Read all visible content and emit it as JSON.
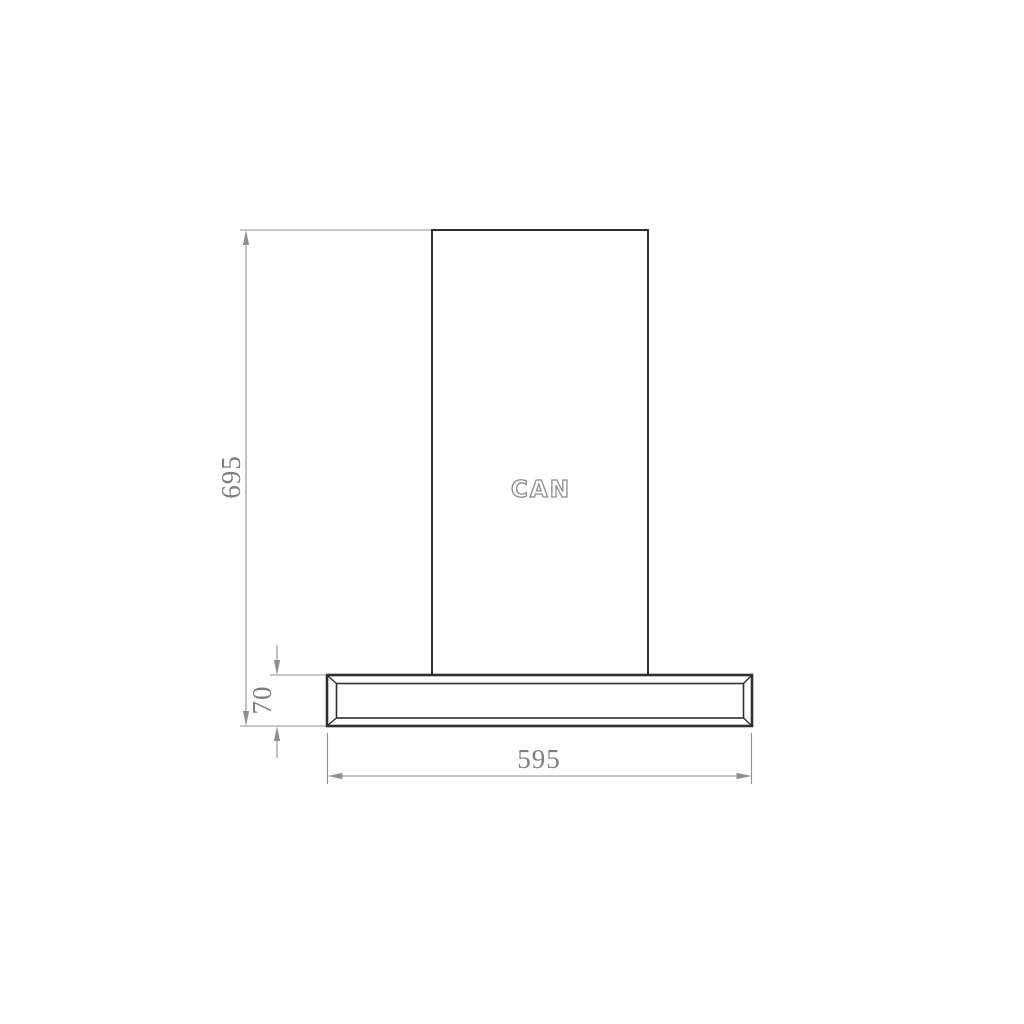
{
  "drawing": {
    "logo_text": "CAN",
    "dimensions": {
      "total_height": "695",
      "body_height": "70",
      "width": "595"
    },
    "colors": {
      "background": "#ffffff",
      "product_outline": "#2f2f2f",
      "dimension_lines": "#8f8f8f",
      "dimension_text": "#7e7e7e",
      "logo_outline": "#8c8c8c"
    }
  }
}
